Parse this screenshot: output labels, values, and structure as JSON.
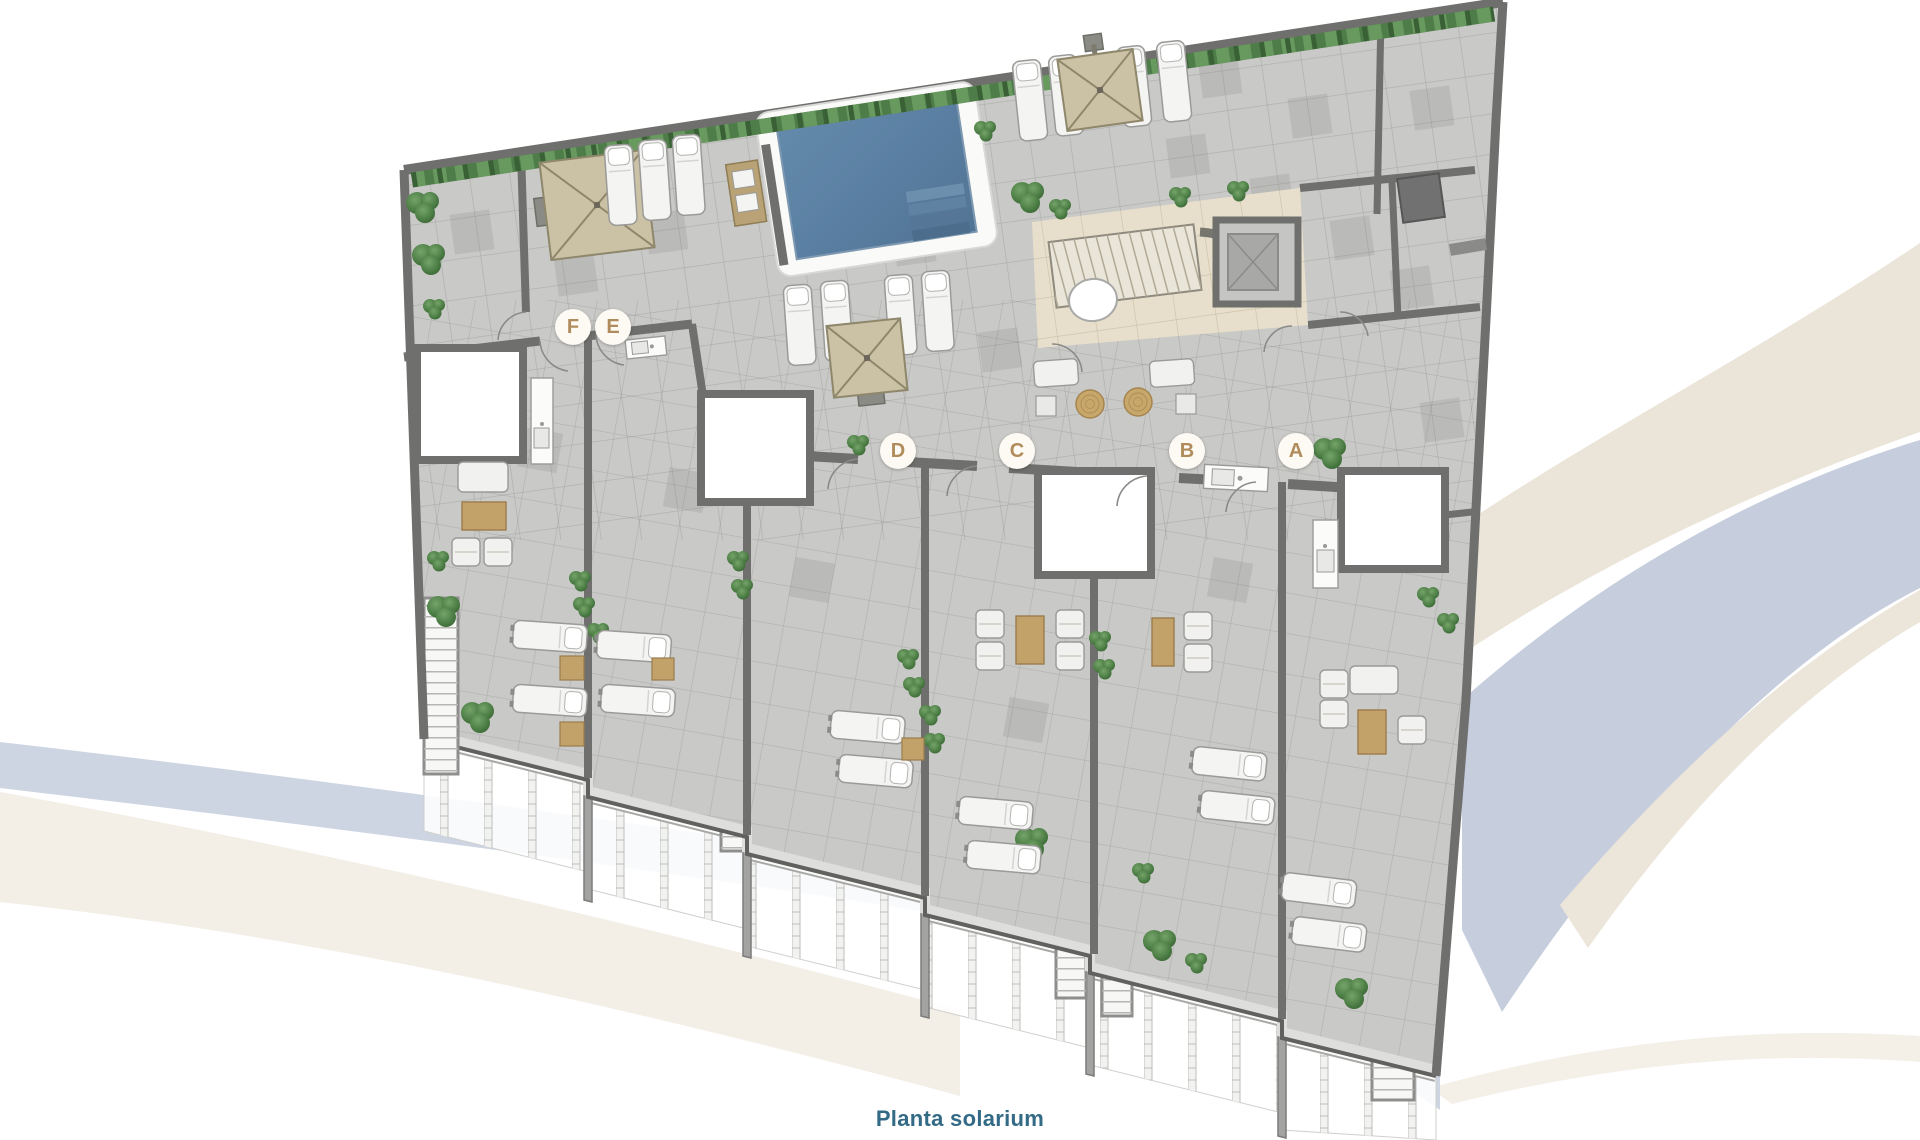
{
  "caption": {
    "text": "Planta solarium"
  },
  "plan": {
    "name": "solarium-floor-plan",
    "units": [
      {
        "label": "A"
      },
      {
        "label": "B"
      },
      {
        "label": "C"
      },
      {
        "label": "D"
      },
      {
        "label": "E"
      },
      {
        "label": "F"
      }
    ]
  },
  "colors": {
    "caption_text": "#336a85",
    "unit_letter": "#b08c5c",
    "unit_marker_bg": "#fdfaf3",
    "deck_tile": "#c9c9c7",
    "wall": "#6f6f6d",
    "pool_water": "#5e81a3",
    "pool_deck": "#fafaf8",
    "indoor_floor": "#e7dfcc",
    "umbrella_canvas": "#cbc1a5",
    "hedge_green": "#4f7d49",
    "furniture_wood": "#c3a269",
    "railing_white": "#f6f6f4",
    "swoosh_beige": "#ebe4d8",
    "swoosh_blue": "#c6cede"
  }
}
